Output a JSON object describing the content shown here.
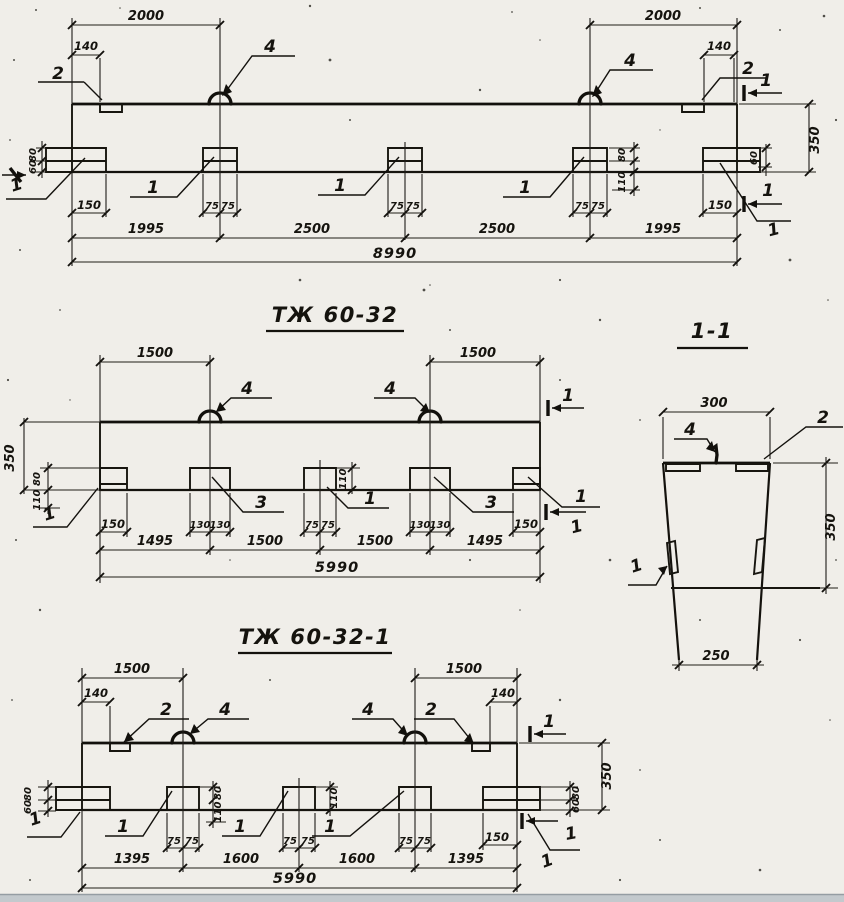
{
  "colors": {
    "ink": "#15130e",
    "paper": "#f0eee9",
    "scan_band": "#c3c9cd"
  },
  "beam1": {
    "dims": {
      "span_left": "2000",
      "span_right": "2000",
      "plate_offset_left": "140",
      "plate_offset_right": "140",
      "height": "350",
      "left_upper": "80",
      "left_lower": "60",
      "right_side": "60",
      "block_upper": "80",
      "block_lower": "110",
      "end_left": "150",
      "end_right": "150",
      "block_half": "75",
      "seg_1": "1995",
      "seg_2": "2500",
      "seg_3": "2500",
      "seg_4": "1995",
      "total": "8990"
    },
    "callouts": {
      "plate": "2",
      "loop": "4",
      "embed": "1",
      "section": "1"
    }
  },
  "beam2": {
    "title": "ТЖ 60-32",
    "dims": {
      "span_left": "1500",
      "span_right": "1500",
      "height": "350",
      "left_upper": "80",
      "left_lower": "110",
      "mid_block": "110",
      "end_left": "150",
      "end_right": "150",
      "block_half_130": "130",
      "block_half_75": "75",
      "seg_1": "1495",
      "seg_2": "1500",
      "seg_3": "1500",
      "seg_4": "1495",
      "total": "5990"
    },
    "callouts": {
      "embed": "1",
      "weld": "3",
      "loop": "4",
      "section": "1"
    }
  },
  "beam3": {
    "title": "ТЖ 60-32-1",
    "dims": {
      "span_left": "1500",
      "span_right": "1500",
      "plate_offset_left": "140",
      "plate_offset_right": "140",
      "height": "350",
      "left_upper": "80",
      "left_lower": "60",
      "right_upper": "80",
      "right_lower": "60",
      "block2_upper": "80",
      "block2_lower": "110",
      "block3_depth": "110",
      "end_right": "150",
      "block_half": "75",
      "seg_1": "1395",
      "seg_2": "1600",
      "seg_3": "1600",
      "seg_4": "1395",
      "total": "5990"
    },
    "callouts": {
      "plate": "2",
      "loop": "4",
      "embed": "1",
      "section": "1"
    }
  },
  "section11": {
    "title": "1-1",
    "dims": {
      "width_top": "300",
      "width_bottom": "250",
      "height": "350"
    },
    "callouts": {
      "loop": "4",
      "plate": "2",
      "embed": "1"
    }
  }
}
